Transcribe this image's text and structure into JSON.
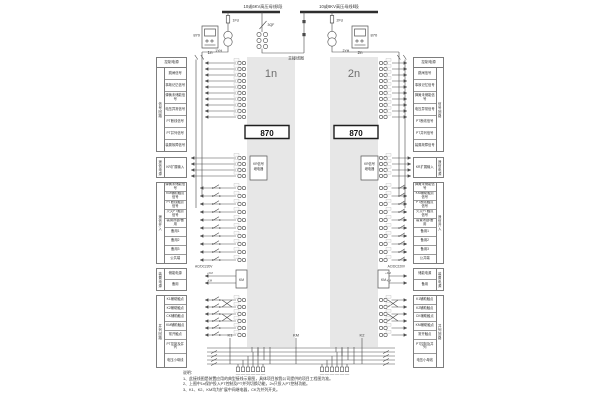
{
  "bus": {
    "left": "10或6KV高压母线Ⅰ段",
    "right": "10或6KV高压母线Ⅱ段",
    "tie_switch": "3QF",
    "tie_label": "主接线图"
  },
  "units": {
    "left": {
      "device": "870",
      "name": "1n",
      "fuse": "1FU",
      "pt": "1YH"
    },
    "right": {
      "device": "870",
      "name": "2n",
      "fuse": "2FU",
      "pt": "2YH"
    }
  },
  "panels": {
    "left_title": "1n",
    "right_title": "2n",
    "badge": "870",
    "kr_line1": "KR信号",
    "kr_line2": "继电器",
    "km_label": "KM"
  },
  "tables": {
    "signal": {
      "header": "控制电源",
      "side": "信号回路",
      "rows": [
        "跳闸信号",
        "事故记忆信号",
        "弹簧未储能信号",
        "电压异常信号",
        "PT断线信号",
        "PT并列信号",
        "装置故障信号"
      ]
    },
    "kr": {
      "side": "遥信电源",
      "label": "KR扩展输入"
    },
    "telemetry": {
      "side": "遥信开入",
      "rows": [
        "弹簧未储能信号",
        "KM辅助触点信号",
        "PT断线触点信号",
        "火灾PT触点信号",
        "装置闭锁/备用",
        "备用1",
        "备用2",
        "备用3",
        "公共端"
      ]
    },
    "power": {
      "side": "装置电源",
      "rows": [
        "储能电源",
        "备用"
      ],
      "ext": "AC/DC220V"
    },
    "parallel": {
      "side": "并列回路",
      "rows": [
        "K1辅助触点",
        "K2辅助触点",
        "CK辅助触点",
        "KM辅助触点",
        "常开触点",
        "PT控制及并列",
        "电压小母线"
      ]
    }
  },
  "bottom": {
    "relays": [
      "K1",
      "KM",
      "K2"
    ],
    "km_plus": "+KM",
    "km_minus": "-KM"
  },
  "notes": {
    "title": "说明：",
    "items": [
      "1、此接线图是装置应用的典型接线示意图，具体项目按我公司提供的项目工程图为准。",
      "2、上图中1n保护投入PT控制及PT并列切换功能，2n只投入PT控制功能。",
      "3、K1、K2、KM均为扩展中间继电器，CK为并列开关。"
    ]
  }
}
